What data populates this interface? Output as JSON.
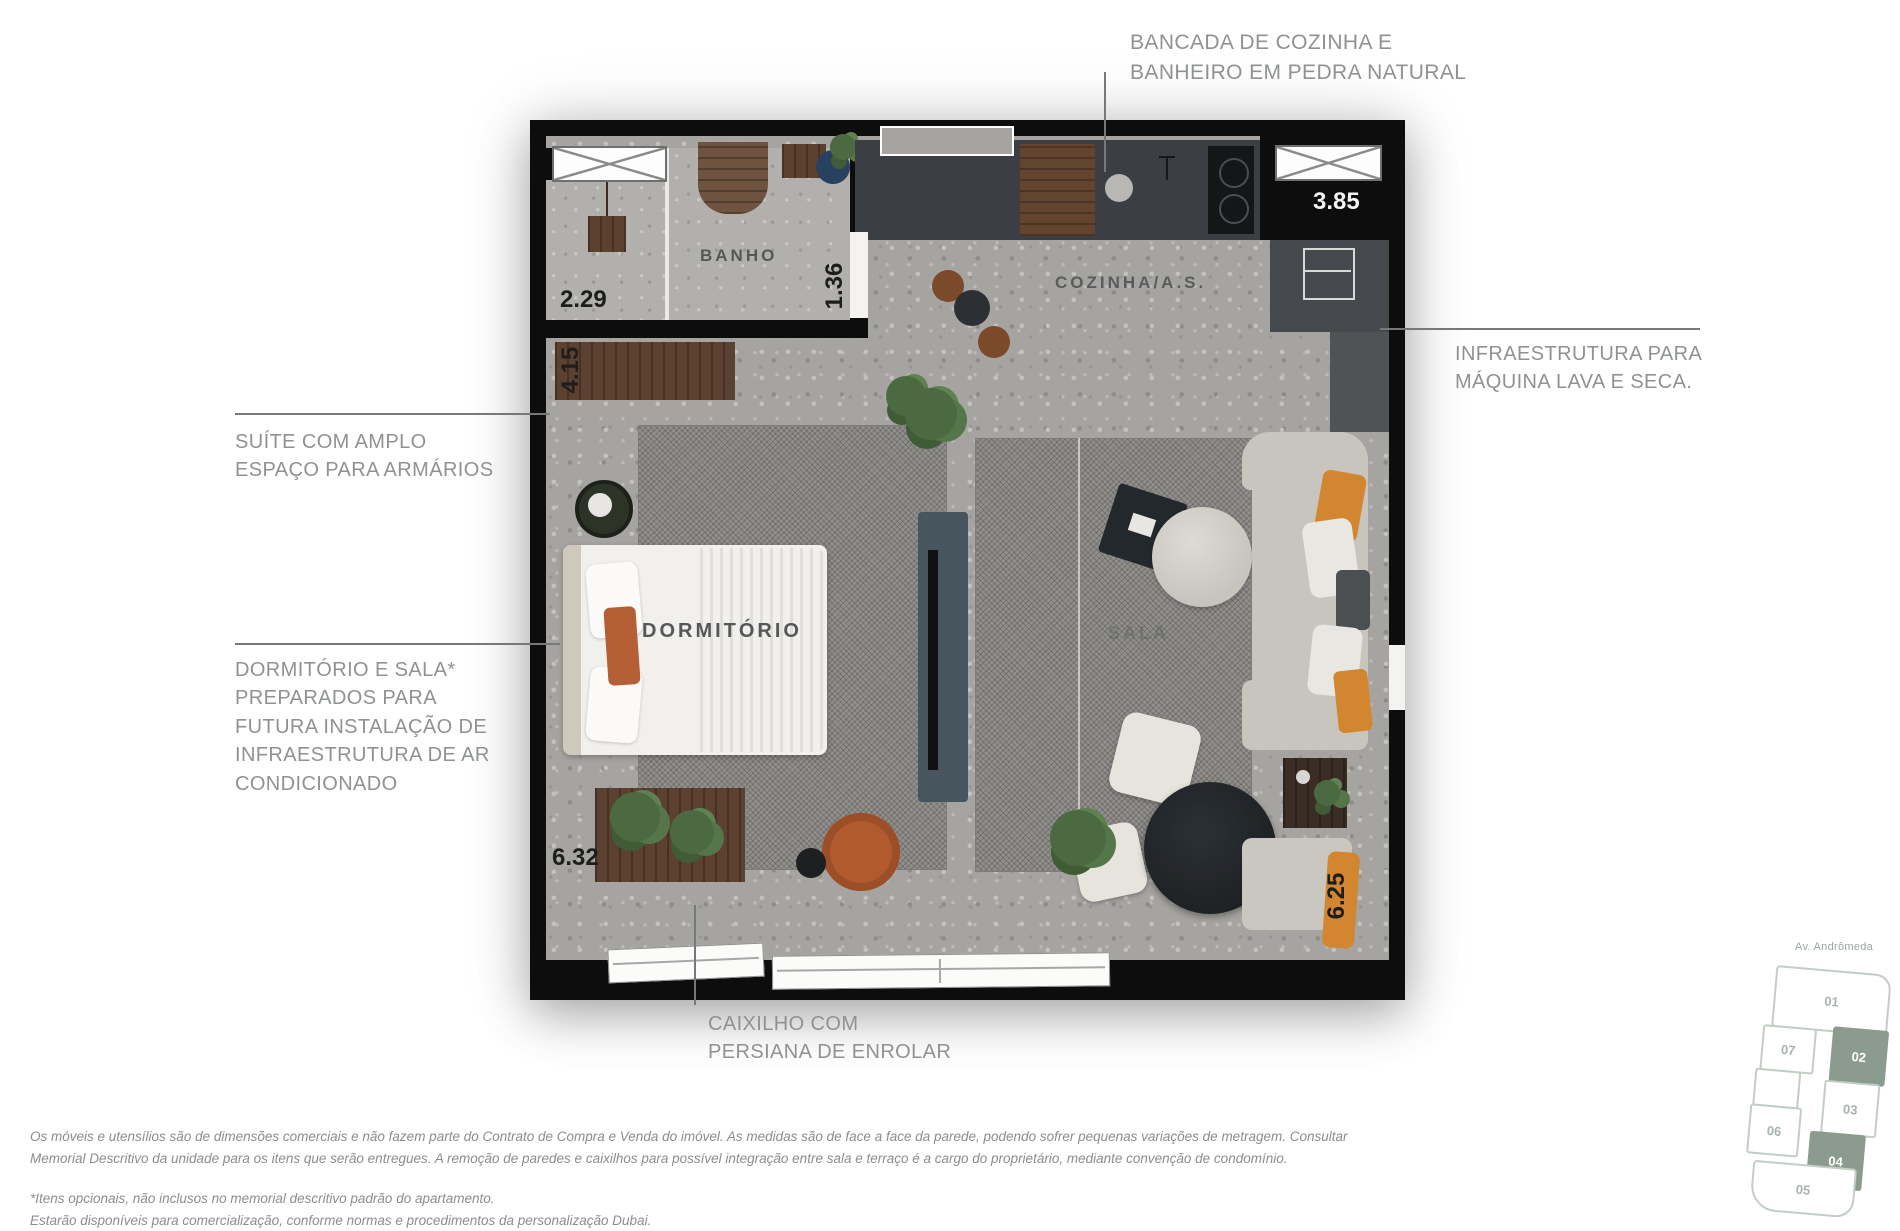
{
  "annotations": {
    "bancada": "BANCADA DE COZINHA E\nBANHEIRO EM PEDRA NATURAL",
    "infra_lava_seca": "INFRAESTRUTURA PARA\nMÁQUINA LAVA E SECA.",
    "suite": "SUÍTE COM AMPLO\nESPAÇO PARA ARMÁRIOS",
    "ar_condicionado": "DORMITÓRIO E SALA*\nPREPARADOS PARA\nFUTURA INSTALAÇÃO DE\nINFRAESTRUTURA DE AR\nCONDICIONADO",
    "caixilho": "CAIXILHO COM\nPERSIANA DE ENROLAR"
  },
  "rooms": {
    "banho": "BANHO",
    "cozinha": "COZINHA/A.S.",
    "dormitorio": "DORMITÓRIO",
    "sala": "SALA"
  },
  "dimensions": {
    "closet": "2.29",
    "banho": "1.36",
    "suite_wardrobe": "4.15",
    "cozinha": "3.85",
    "frente_inferior": "6.32",
    "lateral_inferior": "6.25"
  },
  "key_plan": {
    "street": "Av. Andrômeda",
    "units": [
      {
        "label": "01",
        "highlighted": false
      },
      {
        "label": "07",
        "highlighted": false
      },
      {
        "label": "02",
        "highlighted": true
      },
      {
        "label": "03",
        "highlighted": false
      },
      {
        "label": "06",
        "highlighted": false
      },
      {
        "label": "04",
        "highlighted": true
      },
      {
        "label": "05",
        "highlighted": false
      }
    ]
  },
  "disclaimer": {
    "paragraph1": "Os móveis e utensílios são de dimensões comerciais e não fazem parte do Contrato de Compra e Venda do imóvel.  As medidas são de face a face da parede, podendo sofrer pequenas variações de metragem. Consultar\nMemorial Descritivo da unidade para os itens que serão entregues. A remoção de paredes e caixilhos para possível integração entre sala e terraço é a cargo do proprietário, mediante convenção de condomínio.",
    "paragraph2": "*Itens opcionais, não inclusos no memorial descritivo padrão do apartamento.\nEstarão disponíveis para comercialização, conforme normas e procedimentos da personalização Dubai."
  },
  "colors": {
    "highlight_unit": "#8b9c8f",
    "annotation_text": "#8f9294",
    "wall": "#0d0d0d"
  }
}
